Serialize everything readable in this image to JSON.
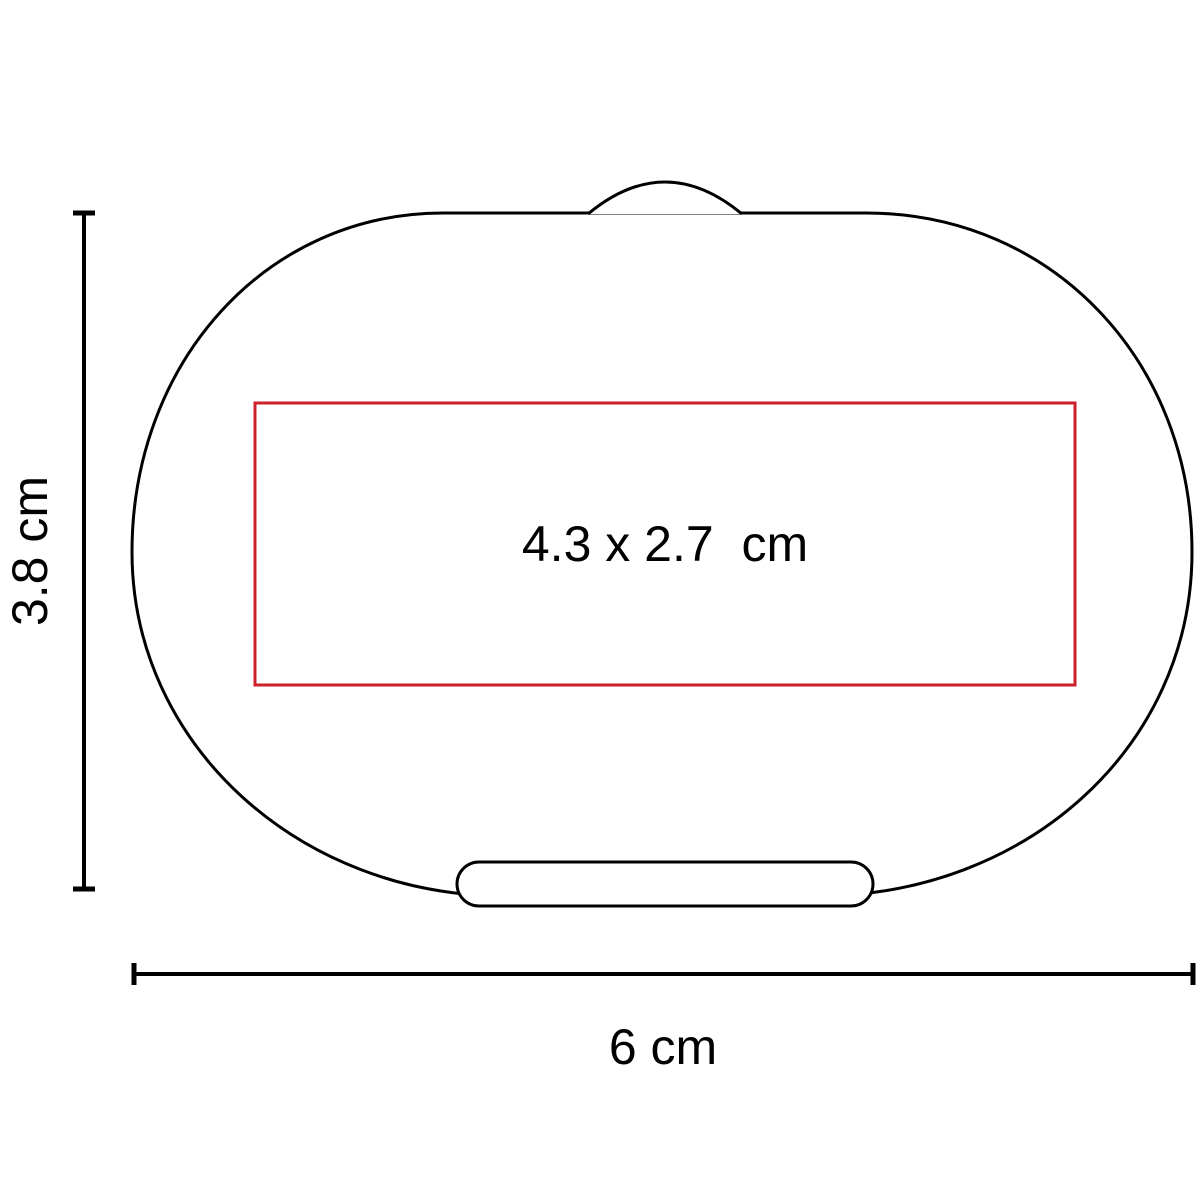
{
  "diagram": {
    "background_color": "#ffffff",
    "outline_color": "#000000",
    "text_color": "#000000",
    "product": {
      "shape": "oval pill box top view",
      "features": [
        "hinge-bump-top",
        "latch-pill-bottom"
      ]
    },
    "imprint_area": {
      "label": "4.3 x 2.7  cm",
      "border_color": "#cc202b"
    },
    "height_dimension": {
      "label": "3.8 cm",
      "orientation": "vertical"
    },
    "width_dimension": {
      "label": "6 cm",
      "orientation": "horizontal"
    }
  }
}
